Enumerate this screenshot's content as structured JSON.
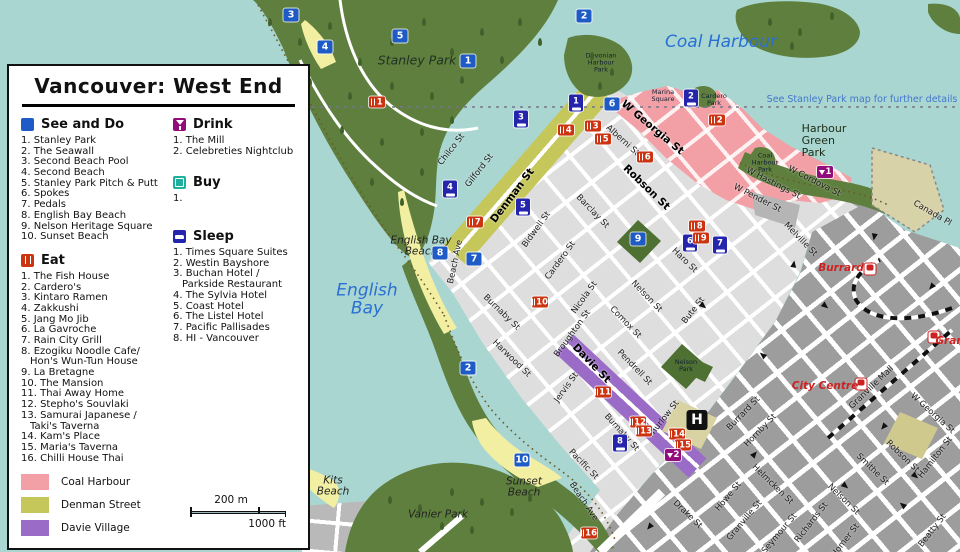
{
  "legend": {
    "title": "Vancouver:  West End",
    "sections": {
      "see": {
        "label": "See and Do",
        "items": [
          "Stanley Park",
          "The Seawall",
          "Second Beach Pool",
          "Second Beach",
          "Stanley Park Pitch & Putt",
          "Spokes",
          "Pedals",
          "English Bay Beach",
          "Nelson Heritage Square",
          "Sunset Beach"
        ]
      },
      "eat": {
        "label": "Eat",
        "items": [
          "The Fish House",
          "Cardero's",
          "Kintaro Ramen",
          "Zakkushi",
          "Jang Mo Jib",
          "La Gavroche",
          "Rain City Grill",
          "Ezogiku Noodle Cafe/\nHon's Wun-Tun House",
          "La Bretagne",
          "The Mansion",
          "Thai Away Home",
          "Stepho's Souvlaki",
          "Samurai Japanese /\nTaki's Taverna",
          "Kam's Place",
          "Maria's Taverna",
          "Chilli House Thai"
        ]
      },
      "drink": {
        "label": "Drink",
        "items": [
          "The Mill",
          "Celebreties Nightclub"
        ]
      },
      "buy": {
        "label": "Buy",
        "items": [
          ""
        ]
      },
      "sleep": {
        "label": "Sleep",
        "items": [
          "Times Square Suites",
          "Westin Bayshore",
          "Buchan Hotel /\nParkside Restaurant",
          "The Sylvia Hotel",
          "Coast Hotel",
          "The Listel Hotel",
          "Pacific Pallisades",
          "HI - Vancouver"
        ]
      }
    },
    "areas": [
      {
        "label": "Coal Harbour",
        "color": "#F2A0A6"
      },
      {
        "label": "Denman Street",
        "color": "#C6C75B"
      },
      {
        "label": "Davie Village",
        "color": "#9B6BC8"
      }
    ],
    "scale": {
      "top": "200 m",
      "bottom": "1000 ft"
    }
  },
  "map": {
    "note": {
      "text": "See Stanley Park map for further details",
      "x": 862,
      "y": 100
    },
    "water_labels": [
      {
        "text": "Coal Harbour",
        "x": 721,
        "y": 42
      },
      {
        "text": "English\nBay",
        "x": 367,
        "y": 300
      }
    ],
    "place_labels": [
      {
        "text": "Stanley Park",
        "x": 417,
        "y": 60,
        "cls": "pl-lg"
      },
      {
        "text": "English Bay\nBeach",
        "x": 421,
        "y": 247,
        "cls": "pl-md"
      },
      {
        "text": "Sunset\nBeach",
        "x": 524,
        "y": 488,
        "cls": "pl-md"
      },
      {
        "text": "Kits\nBeach",
        "x": 333,
        "y": 487,
        "cls": "pl-md"
      },
      {
        "text": "Vanier Park",
        "x": 438,
        "y": 515,
        "cls": "pl-md"
      },
      {
        "text": "Harbour\nGreen\nPark",
        "x": 824,
        "y": 141,
        "cls": "pl-park"
      },
      {
        "text": "Devonian\nHarbour\nPark",
        "x": 601,
        "y": 63,
        "cls": "pl-xs"
      },
      {
        "text": "Marina\nSquare",
        "x": 663,
        "y": 96,
        "cls": "pl-xs"
      },
      {
        "text": "Cardero\nPark",
        "x": 714,
        "y": 100,
        "cls": "pl-xs"
      },
      {
        "text": "Coal\nHarbour\nPark",
        "x": 765,
        "y": 163,
        "cls": "pl-xs"
      },
      {
        "text": "Nelson\nPark",
        "x": 686,
        "y": 366,
        "cls": "pl-xs"
      }
    ],
    "street_labels": [
      {
        "t": "Chilco St",
        "x": 452,
        "y": 150,
        "r": -52
      },
      {
        "t": "Gilford St",
        "x": 480,
        "y": 171,
        "r": -52
      },
      {
        "t": "Denman St",
        "x": 513,
        "y": 196,
        "r": -53,
        "b": 1
      },
      {
        "t": "Bidwell St",
        "x": 537,
        "y": 230,
        "r": -54
      },
      {
        "t": "Cardero St",
        "x": 561,
        "y": 261,
        "r": -54
      },
      {
        "t": "Nicola St",
        "x": 585,
        "y": 298,
        "r": -54
      },
      {
        "t": "Broughton St",
        "x": 573,
        "y": 334,
        "r": -54
      },
      {
        "t": "Jervis St",
        "x": 567,
        "y": 388,
        "r": -54
      },
      {
        "t": "Bute St",
        "x": 694,
        "y": 311,
        "r": -52
      },
      {
        "t": "Thurlow St",
        "x": 664,
        "y": 420,
        "r": -52
      },
      {
        "t": "Burrard St",
        "x": 744,
        "y": 414,
        "r": -46
      },
      {
        "t": "Hornby St",
        "x": 761,
        "y": 431,
        "r": -46
      },
      {
        "t": "Howe St",
        "x": 729,
        "y": 497,
        "r": -50
      },
      {
        "t": "Granville St",
        "x": 745,
        "y": 521,
        "r": -50
      },
      {
        "t": "Seymour St",
        "x": 780,
        "y": 534,
        "r": -50
      },
      {
        "t": "Richards St",
        "x": 812,
        "y": 523,
        "r": -52
      },
      {
        "t": "Homer St",
        "x": 846,
        "y": 541,
        "r": -52
      },
      {
        "t": "Hamilton St",
        "x": 936,
        "y": 458,
        "r": -52
      },
      {
        "t": "Beatty St",
        "x": 933,
        "y": 531,
        "r": -52
      },
      {
        "t": "Granville Mall",
        "x": 872,
        "y": 388,
        "r": -44
      },
      {
        "t": "Helmcken St",
        "x": 772,
        "y": 485,
        "r": 44
      },
      {
        "t": "Smithe St",
        "x": 872,
        "y": 470,
        "r": 44
      },
      {
        "t": "Nelson St",
        "x": 843,
        "y": 500,
        "r": 44
      },
      {
        "t": "Robson St",
        "x": 902,
        "y": 457,
        "r": 44
      },
      {
        "t": "W Georgia St",
        "x": 932,
        "y": 414,
        "r": 42
      },
      {
        "t": "Canada Pl",
        "x": 932,
        "y": 214,
        "r": 30
      },
      {
        "t": "Melville St",
        "x": 800,
        "y": 240,
        "r": 46
      },
      {
        "t": "W Cordova St",
        "x": 814,
        "y": 182,
        "r": 27
      },
      {
        "t": "W Hastings St",
        "x": 773,
        "y": 184,
        "r": 27
      },
      {
        "t": "W Pender St",
        "x": 757,
        "y": 199,
        "r": 27
      },
      {
        "t": "W Georgia St",
        "x": 652,
        "y": 128,
        "r": 40,
        "b": 1
      },
      {
        "t": "Alberni St",
        "x": 622,
        "y": 141,
        "r": 42
      },
      {
        "t": "Robson St",
        "x": 646,
        "y": 188,
        "r": 44,
        "b": 1
      },
      {
        "t": "Haro St",
        "x": 684,
        "y": 261,
        "r": 44
      },
      {
        "t": "Barclay St",
        "x": 592,
        "y": 212,
        "r": 46
      },
      {
        "t": "Nelson St",
        "x": 646,
        "y": 297,
        "r": 46
      },
      {
        "t": "Comox St",
        "x": 625,
        "y": 323,
        "r": 46
      },
      {
        "t": "Pendrell St",
        "x": 634,
        "y": 368,
        "r": 46
      },
      {
        "t": "Davie St",
        "x": 591,
        "y": 364,
        "r": 46,
        "b": 1
      },
      {
        "t": "Burnaby St",
        "x": 501,
        "y": 313,
        "r": 44
      },
      {
        "t": "Burnaby St",
        "x": 621,
        "y": 433,
        "r": 48
      },
      {
        "t": "Harwood St",
        "x": 511,
        "y": 359,
        "r": 44
      },
      {
        "t": "Pacific St",
        "x": 583,
        "y": 465,
        "r": 46
      },
      {
        "t": "Beach Ave",
        "x": 456,
        "y": 262,
        "r": -78
      },
      {
        "t": "Beach Ave",
        "x": 583,
        "y": 502,
        "r": 56
      },
      {
        "t": "Drake St",
        "x": 687,
        "y": 515,
        "r": 44
      }
    ],
    "markers": [
      {
        "type": "see",
        "n": "1",
        "x": 468,
        "y": 61
      },
      {
        "type": "see",
        "n": "2",
        "x": 584,
        "y": 16
      },
      {
        "type": "see",
        "n": "2",
        "x": 468,
        "y": 368
      },
      {
        "type": "see",
        "n": "3",
        "x": 291,
        "y": 15
      },
      {
        "type": "see",
        "n": "4",
        "x": 325,
        "y": 47
      },
      {
        "type": "see",
        "n": "5",
        "x": 400,
        "y": 36
      },
      {
        "type": "see",
        "n": "6",
        "x": 612,
        "y": 104
      },
      {
        "type": "see",
        "n": "7",
        "x": 474,
        "y": 259
      },
      {
        "type": "see",
        "n": "8",
        "x": 440,
        "y": 253
      },
      {
        "type": "see",
        "n": "9",
        "x": 638,
        "y": 239
      },
      {
        "type": "see",
        "n": "10",
        "x": 522,
        "y": 460
      },
      {
        "type": "sleep",
        "n": "1",
        "x": 576,
        "y": 103
      },
      {
        "type": "sleep",
        "n": "2",
        "x": 691,
        "y": 98
      },
      {
        "type": "sleep",
        "n": "3",
        "x": 521,
        "y": 119
      },
      {
        "type": "sleep",
        "n": "4",
        "x": 450,
        "y": 189
      },
      {
        "type": "sleep",
        "n": "5",
        "x": 523,
        "y": 207
      },
      {
        "type": "sleep",
        "n": "6",
        "x": 690,
        "y": 243
      },
      {
        "type": "sleep",
        "n": "7",
        "x": 720,
        "y": 245
      },
      {
        "type": "sleep",
        "n": "8",
        "x": 620,
        "y": 443
      },
      {
        "type": "eat",
        "n": "1",
        "x": 377,
        "y": 102
      },
      {
        "type": "eat",
        "n": "2",
        "x": 717,
        "y": 120
      },
      {
        "type": "eat",
        "n": "3",
        "x": 593,
        "y": 126
      },
      {
        "type": "eat",
        "n": "4",
        "x": 566,
        "y": 130
      },
      {
        "type": "eat",
        "n": "5",
        "x": 603,
        "y": 139
      },
      {
        "type": "eat",
        "n": "6",
        "x": 645,
        "y": 157
      },
      {
        "type": "eat",
        "n": "7",
        "x": 475,
        "y": 222
      },
      {
        "type": "eat",
        "n": "8",
        "x": 697,
        "y": 226
      },
      {
        "type": "eat",
        "n": "9",
        "x": 701,
        "y": 238
      },
      {
        "type": "eat",
        "n": "10",
        "x": 540,
        "y": 302
      },
      {
        "type": "eat",
        "n": "11",
        "x": 603,
        "y": 392
      },
      {
        "type": "eat",
        "n": "12",
        "x": 638,
        "y": 422
      },
      {
        "type": "eat",
        "n": "13",
        "x": 644,
        "y": 431
      },
      {
        "type": "eat",
        "n": "14",
        "x": 677,
        "y": 434
      },
      {
        "type": "eat",
        "n": "15",
        "x": 683,
        "y": 445
      },
      {
        "type": "eat",
        "n": "16",
        "x": 589,
        "y": 533
      },
      {
        "type": "drink",
        "n": "1",
        "x": 825,
        "y": 172
      },
      {
        "type": "drink",
        "n": "2",
        "x": 673,
        "y": 455
      }
    ],
    "hospital": {
      "label": "H",
      "x": 697,
      "y": 420
    },
    "stations": [
      {
        "name": "Burrard",
        "ix": 870,
        "iy": 269,
        "lx": 841,
        "ly": 268
      },
      {
        "name": "City Centre",
        "ix": 861,
        "iy": 384,
        "lx": 825,
        "ly": 386
      },
      {
        "name": "Granville",
        "ix": 934,
        "iy": 337,
        "lx": 962,
        "ly": 341
      }
    ]
  },
  "colors": {
    "water": "#A9D6D1",
    "park": "#5E7F3D",
    "park_dark": "#41612C",
    "beach": "#F2EFA3",
    "westend": "#DEDEDE",
    "downtown": "#9D9D9D",
    "coal": "#F2A0A6",
    "denman": "#C6C75B",
    "davie": "#9B6BC8",
    "see": "#1E5BC6",
    "eat": "#CC3311",
    "drink": "#930C7C",
    "sleep": "#2424AC",
    "buy": "#1FAF9E",
    "station": "#CC2222",
    "wlabel": "#2A6FD4",
    "note": "#4477CC",
    "pier": "#D8D2A8",
    "khaki": "#CFC98E"
  }
}
